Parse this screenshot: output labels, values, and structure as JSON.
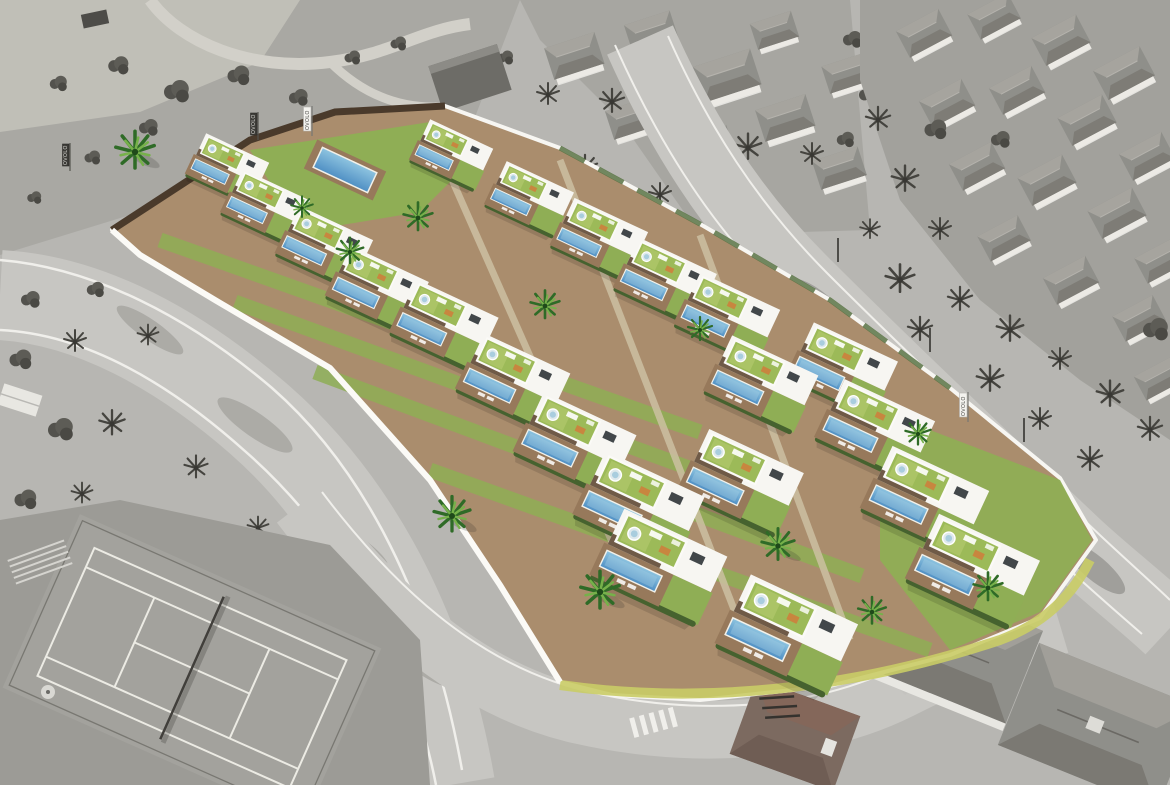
{
  "flags": {
    "logo_text": "OVOLO"
  },
  "colors": {
    "pool": "#4f8fc4",
    "pool_light": "#8ec4e0",
    "lawn": "#8fae55",
    "roof_grass": "#9cba58",
    "deck": "#97795b",
    "wood": "#aa8d6d",
    "hedge": "#46622f",
    "fence": "#4a3a2b",
    "wall_white": "#f7f6f2",
    "slat": "#6f5a47",
    "palm_dark": "#2f6b27",
    "palm_light": "#76b14a",
    "base_gray": "#b7b6b2",
    "road_gray": "#c7c6c2",
    "veg_gray": "#50504b",
    "build_gray": "#e4e3df",
    "roof_gray": "#8f8f8a",
    "court_gray": "#a3a29d",
    "line_white": "#f0efeb",
    "lawn_edge": "#c9cc66"
  }
}
